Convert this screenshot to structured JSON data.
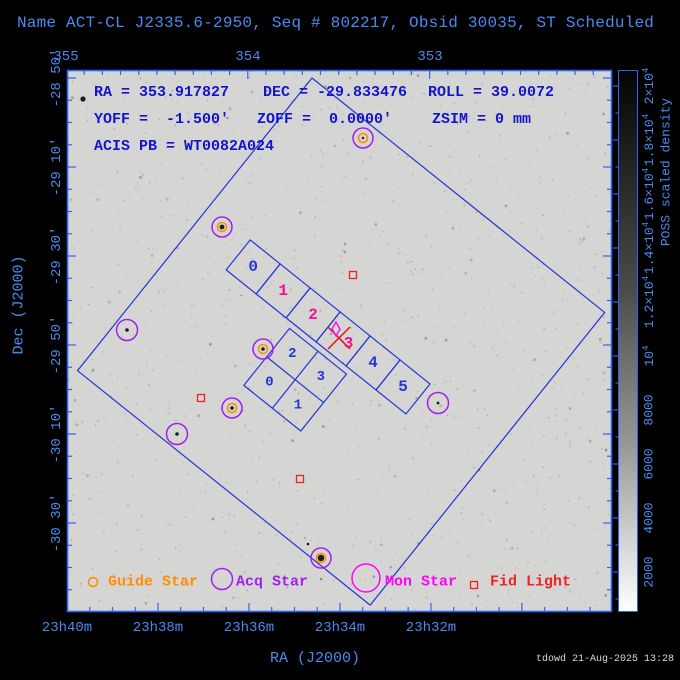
{
  "window": {
    "title": "Name ACT-CL J2335.6-2950, Seq # 802217, Obsid 30035, ST Scheduled",
    "footer": "tdowd 21-Aug-2025 13:28"
  },
  "info": {
    "ra": "RA = 353.917827",
    "dec": "DEC = -29.833476",
    "roll": "ROLL = 39.0072",
    "yoff": "YOFF =  -1.500'",
    "zoff": "ZOFF =  0.0000'",
    "zsim": "ZSIM = 0 mm",
    "acis_pb": "ACIS PB = WT0082A024"
  },
  "plot": {
    "x": 67,
    "y": 70,
    "w": 545,
    "h": 542
  },
  "colors": {
    "axis_frame": "#2e64f0",
    "axis_label": "#4b8bef",
    "info_text": "#1414cc",
    "fov_line": "#2336d6",
    "chip_pink": "#ee1099",
    "aimpoint_red": "#e81010",
    "guide_orange": "#ff8c00",
    "acq_purple": "#a020f0",
    "mon_magenta": "#ff00ff",
    "fid_red": "#ee2222"
  },
  "axes": {
    "top": {
      "tick_labels": [
        {
          "text": "355",
          "x": 66
        },
        {
          "text": "354",
          "x": 248
        },
        {
          "text": "353",
          "x": 430
        }
      ],
      "minor_step": 18.18,
      "minor_count": 30,
      "major_every": 10,
      "label_y": 57
    },
    "bottom": {
      "title": "RA (J2000)",
      "tick_labels": [
        {
          "text": "23h40m",
          "x": 67
        },
        {
          "text": "23h38m",
          "x": 158
        },
        {
          "text": "23h36m",
          "x": 249
        },
        {
          "text": "23h34m",
          "x": 340
        },
        {
          "text": "23h32m",
          "x": 431
        }
      ],
      "minor_step": 22.745,
      "minor_count": 24,
      "major_every": 4,
      "label_y": 628
    },
    "left": {
      "title": "Dec (J2000)",
      "tick_labels": [
        {
          "text": "-28 50'",
          "y": 78
        },
        {
          "text": "-29 10'",
          "y": 167
        },
        {
          "text": "-29 30'",
          "y": 256
        },
        {
          "text": "-29 50'",
          "y": 345
        },
        {
          "text": "-30 10'",
          "y": 434
        },
        {
          "text": "-30 30'",
          "y": 523
        }
      ],
      "minor_step": 22.25,
      "minor_count": 24,
      "major_every": 4,
      "label_x": 57
    }
  },
  "colorbar": {
    "title": "POSS scaled density",
    "labels": [
      {
        "base": "2000",
        "sup": "",
        "y": 572
      },
      {
        "base": "4000",
        "sup": "",
        "y": 518
      },
      {
        "base": "6000",
        "sup": "",
        "y": 464
      },
      {
        "base": "8000",
        "sup": "",
        "y": 410
      },
      {
        "base": "10",
        "sup": "4",
        "y": 356
      },
      {
        "base": "1.2×10",
        "sup": "4",
        "y": 302
      },
      {
        "base": "1.4×10",
        "sup": "4",
        "y": 248
      },
      {
        "base": "1.6×10",
        "sup": "4",
        "y": 194
      },
      {
        "base": "1.8×10",
        "sup": "4",
        "y": 140
      },
      {
        "base": "2×10",
        "sup": "4",
        "y": 86
      }
    ],
    "minor_ticks_y": [
      599,
      545,
      491,
      437,
      383,
      329,
      275,
      221,
      167,
      113
    ],
    "label_x": 649
  },
  "fov": {
    "x": 312,
    "y": 78,
    "side": 375,
    "rotation": 38.7
  },
  "acis_s": {
    "x0": 53,
    "y0": 165,
    "chip": 38.4,
    "labels": [
      "0",
      "1",
      "2",
      "3",
      "4",
      "5"
    ],
    "label_colors": [
      "blue",
      "pink",
      "pink",
      "pink",
      "blue",
      "blue"
    ],
    "label_dx": [
      0,
      0,
      0,
      7,
      0,
      0
    ]
  },
  "acis_i": {
    "x0": 139,
    "y0": 209.5,
    "size": 73,
    "grid": [
      [
        "2",
        "3"
      ],
      [
        "0",
        "1"
      ]
    ]
  },
  "markers": {
    "guide_stars": [
      [
        363,
        138
      ],
      [
        222,
        227
      ],
      [
        263,
        349
      ],
      [
        232,
        408
      ],
      [
        321,
        558
      ]
    ],
    "acq_only": [
      [
        127,
        330
      ],
      [
        177,
        434
      ],
      [
        438,
        403
      ]
    ],
    "fid_lights": [
      [
        353,
        275
      ],
      [
        201,
        398
      ],
      [
        300,
        479
      ]
    ],
    "aimpoint": [
      339,
      338
    ],
    "star_dots": [
      [
        363,
        138,
        1.2
      ],
      [
        222,
        227,
        2.4
      ],
      [
        263,
        349,
        1.8
      ],
      [
        232,
        408,
        1.8
      ],
      [
        321,
        558,
        3.2
      ],
      [
        127,
        330,
        1.8
      ],
      [
        177,
        434,
        1.8
      ],
      [
        438,
        403,
        1.4
      ],
      [
        83,
        99,
        2.6
      ],
      [
        308,
        544,
        1.3
      ]
    ]
  },
  "legend": {
    "items": [
      {
        "label": "Guide Star",
        "shape": "circle",
        "color": "#ff8c00",
        "cx": 93,
        "cy": 582,
        "r": 4.5,
        "tx": 108
      },
      {
        "label": "Acq Star",
        "shape": "circle",
        "color": "#a020f0",
        "cx": 222,
        "cy": 579,
        "r": 10.5,
        "tx": 236
      },
      {
        "label": "Mon Star",
        "shape": "circle",
        "color": "#ff00ff",
        "cx": 366,
        "cy": 578,
        "r": 14,
        "tx": 385
      },
      {
        "label": "Fid Light",
        "shape": "square",
        "color": "#ee2222",
        "cx": 474,
        "cy": 585,
        "r": 3.5,
        "tx": 490
      }
    ]
  }
}
